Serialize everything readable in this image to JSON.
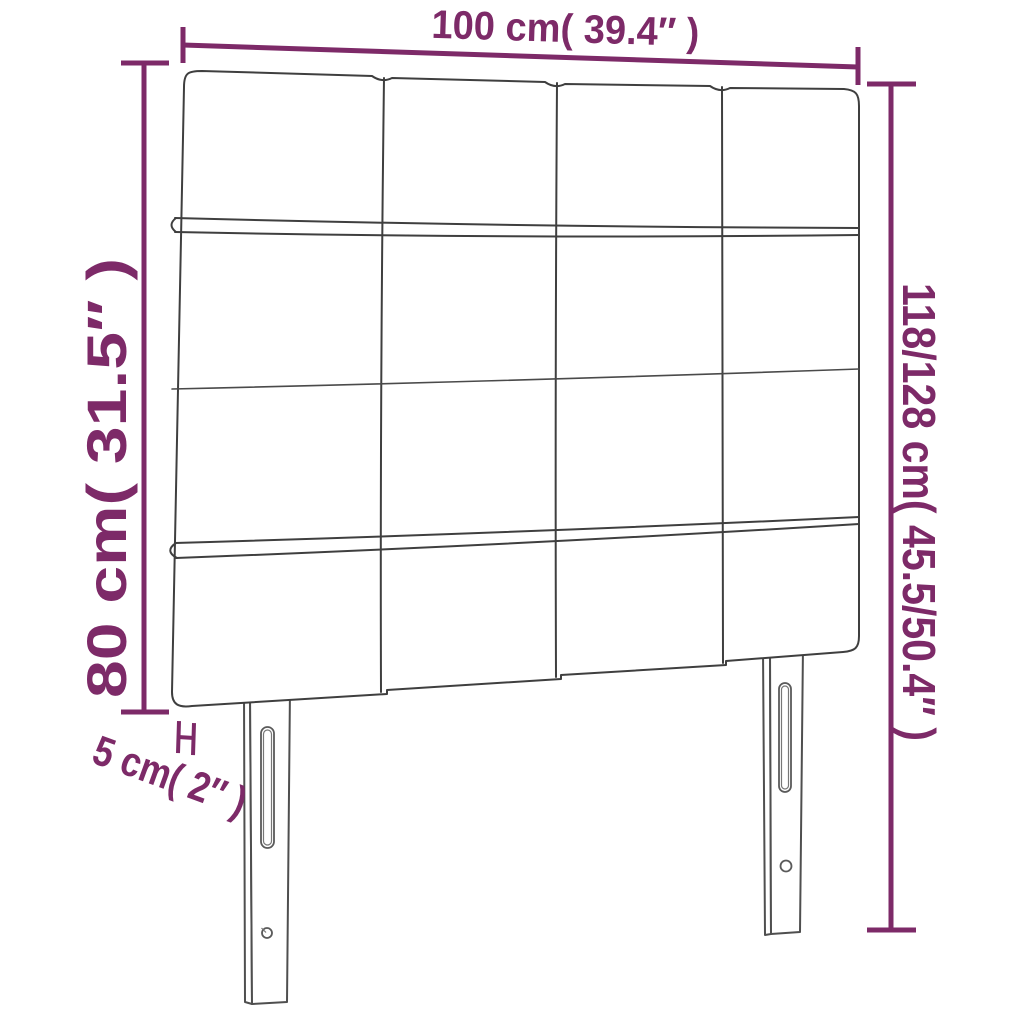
{
  "diagram": {
    "colors": {
      "annotation": "#7D2A68",
      "outline": "#3F3F3F",
      "background": "#FFFFFF"
    },
    "structure": {
      "panel_rows": 4,
      "panel_columns": 4,
      "legs": 2
    },
    "dimensions": {
      "width": {
        "label": "100 cm( 39.4″ )",
        "value_cm": "100",
        "value_in": "39.4"
      },
      "headboard_height": {
        "label": "80 cm( 31.5″ )",
        "value_cm": "80",
        "value_in": "31.5"
      },
      "total_height": {
        "label": "118/128 cm( 45.5/50.4″ )",
        "value_cm": "118/128",
        "value_in": "45.5/50.4"
      },
      "thickness": {
        "label": "5 cm( 2″ )",
        "value_cm": "5",
        "value_in": "2"
      }
    }
  }
}
